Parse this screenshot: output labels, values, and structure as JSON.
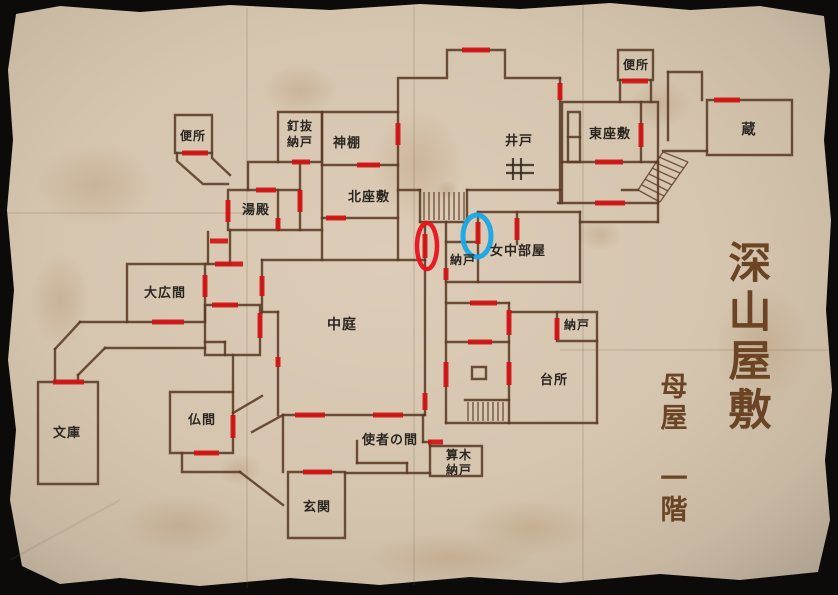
{
  "map": {
    "title": {
      "main": "深山屋敷",
      "sub1": "母屋",
      "sub2": "一階"
    },
    "rooms": [
      {
        "id": "toilet-nw",
        "label": "便所"
      },
      {
        "id": "kuginuki-nando",
        "line1": "釘抜",
        "line2": "納戸"
      },
      {
        "id": "kamidana",
        "label": "神棚"
      },
      {
        "id": "yudono",
        "label": "湯殿"
      },
      {
        "id": "kita-zashiki",
        "label": "北座敷"
      },
      {
        "id": "ido-well",
        "label": "井戸"
      },
      {
        "id": "toilet-ne",
        "label": "便所"
      },
      {
        "id": "higashi-zashiki",
        "label": "東座敷"
      },
      {
        "id": "kura",
        "label": "蔵"
      },
      {
        "id": "nando-center",
        "label": "納戸"
      },
      {
        "id": "jochu-beya",
        "label": "女中部屋"
      },
      {
        "id": "ohiroma",
        "label": "大広間"
      },
      {
        "id": "nakaniwa",
        "label": "中庭"
      },
      {
        "id": "nando-kitchen",
        "label": "納戸"
      },
      {
        "id": "daidokoro",
        "label": "台所"
      },
      {
        "id": "bunko",
        "label": "文庫"
      },
      {
        "id": "butsuma",
        "label": "仏間"
      },
      {
        "id": "shisha-no-ma",
        "label": "使者の間"
      },
      {
        "id": "sangi-nando",
        "line1": "算木",
        "line2": "納戸"
      },
      {
        "id": "genkan",
        "label": "玄関"
      }
    ],
    "annotations": {
      "red_circle_marker": {
        "color": "#e8121c"
      },
      "blue_circle_marker": {
        "color": "#18a7e8"
      }
    },
    "colors": {
      "paper": "#d8c8b2",
      "wall": "#5b3a24",
      "door_marker": "#d31212",
      "title_text": "#6b4425",
      "label_text": "#2b2620",
      "torn_edge": "#0c0b09"
    }
  }
}
